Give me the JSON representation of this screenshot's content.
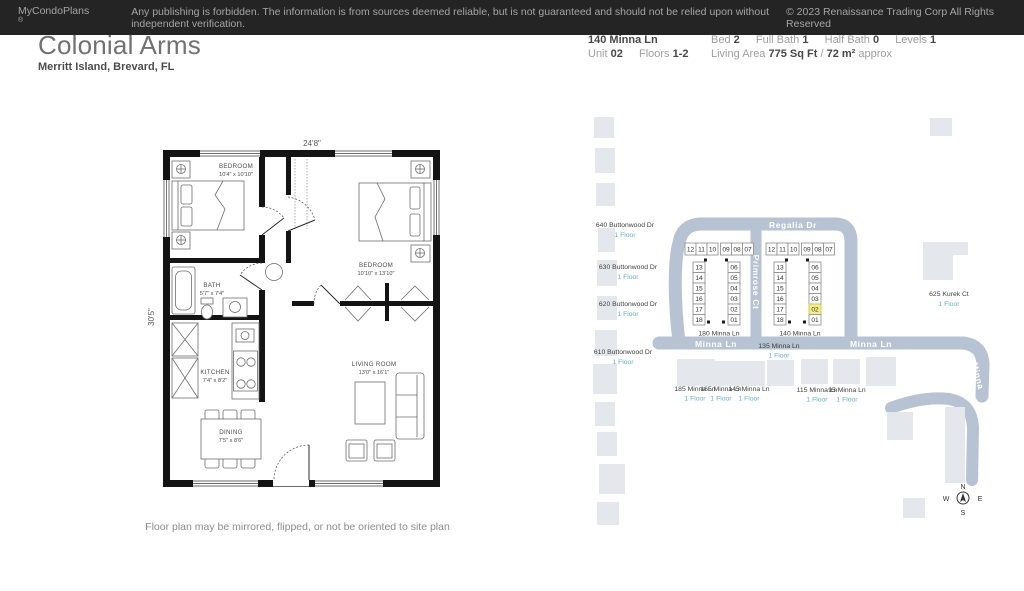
{
  "header": {
    "title": "Colonial Arms",
    "subtitle": "Merritt Island, Brevard, FL",
    "address": "140 Minna Ln",
    "unit_label": "Unit",
    "unit_value": "02",
    "floors_label": "Floors",
    "floors_value": "1-2",
    "bed_label": "Bed",
    "bed_value": "2",
    "full_bath_label": "Full Bath",
    "full_bath_value": "1",
    "half_bath_label": "Half Bath",
    "half_bath_value": "0",
    "levels_label": "Levels",
    "levels_value": "1",
    "living_area_label": "Living Area",
    "living_area_value": "775 Sq Ft",
    "living_area_sep": "/",
    "living_area_metric": "72 m²",
    "living_area_suffix": "approx"
  },
  "floor_plan": {
    "width_dim": "24'8\"",
    "height_dim": "30'5\"",
    "rooms": [
      {
        "name": "BEDROOM",
        "dims": "10'4\" x 10'10\""
      },
      {
        "name": "BEDROOM",
        "dims": "10'10\" x 13'10\""
      },
      {
        "name": "BATH",
        "dims": "5'7\" x 7'4\""
      },
      {
        "name": "KITCHEN",
        "dims": "7'4\" x 8'2\""
      },
      {
        "name": "DINING",
        "dims": "7'5\" x 8'6\""
      },
      {
        "name": "LIVING ROOM",
        "dims": "13'0\" x 16'1\""
      }
    ],
    "note": "Floor plan may be mirrored, flipped, or not be oriented to site plan"
  },
  "site_map": {
    "streets": {
      "regalia": "Regalia Dr",
      "primrose": "Primrose Ct",
      "minna_ln_1": "Minna Ln",
      "minna_ln_2": "Minna Ln",
      "minna_curve": "Minna"
    },
    "left_buildings": [
      {
        "address": "640 Buttonwood Dr",
        "floors": "1 Floor"
      },
      {
        "address": "630 Buttonwood Dr",
        "floors": "1 Floor"
      },
      {
        "address": "620 Buttonwood Dr",
        "floors": "1 Floor"
      },
      {
        "address": "610 Buttonwood Dr",
        "floors": "1 Floor"
      }
    ],
    "unit_buildings": [
      {
        "address": "180 Minna Ln",
        "top_units": [
          "12",
          "11",
          "10",
          "09",
          "08",
          "07"
        ],
        "left_units": [
          "13",
          "14",
          "15",
          "16",
          "17",
          "18"
        ],
        "right_units": [
          "06",
          "05",
          "04",
          "03",
          "02",
          "01"
        ],
        "highlighted_unit": ""
      },
      {
        "address": "140 Minna Ln",
        "top_units": [
          "12",
          "11",
          "10",
          "09",
          "08",
          "07"
        ],
        "left_units": [
          "13",
          "14",
          "15",
          "16",
          "17",
          "18"
        ],
        "right_units": [
          "06",
          "05",
          "04",
          "03",
          "02",
          "01"
        ],
        "highlighted_unit": "02"
      }
    ],
    "kurek": {
      "address": "625 Kurek Ct",
      "floors": "1 Floor"
    },
    "bottom_buildings": [
      {
        "address": "185 Minna Ln",
        "floors": "1 Floor"
      },
      {
        "address": "165 Minna Ln",
        "floors": "1 Floor"
      },
      {
        "address": "145 Minna Ln",
        "floors": "1 Floor"
      },
      {
        "address": "135 Minna Ln",
        "floors": "1 Floor"
      },
      {
        "address": "115 Minna Ln",
        "floors": "1 Floor"
      },
      {
        "address": "95 Minna Ln",
        "floors": "1 Floor"
      }
    ],
    "compass": {
      "n": "N",
      "e": "E",
      "s": "S",
      "w": "W"
    },
    "colors": {
      "road": "#b7c3d2",
      "building": "#e4e7ec",
      "highlight_fill": "#f2ee8e",
      "highlight_border": "#c9bd45",
      "floors_text": "#6aafc6"
    }
  },
  "footer": {
    "brand": "MyCondoPlans",
    "reg_mark": "®",
    "disclaimer": "Any publishing is forbidden. The information is from sources deemed reliable, but is not guaranteed and should not be relied upon without independent verification.",
    "copyright": "© 2023 Renaissance Trading Corp  All Rights Reserved"
  }
}
